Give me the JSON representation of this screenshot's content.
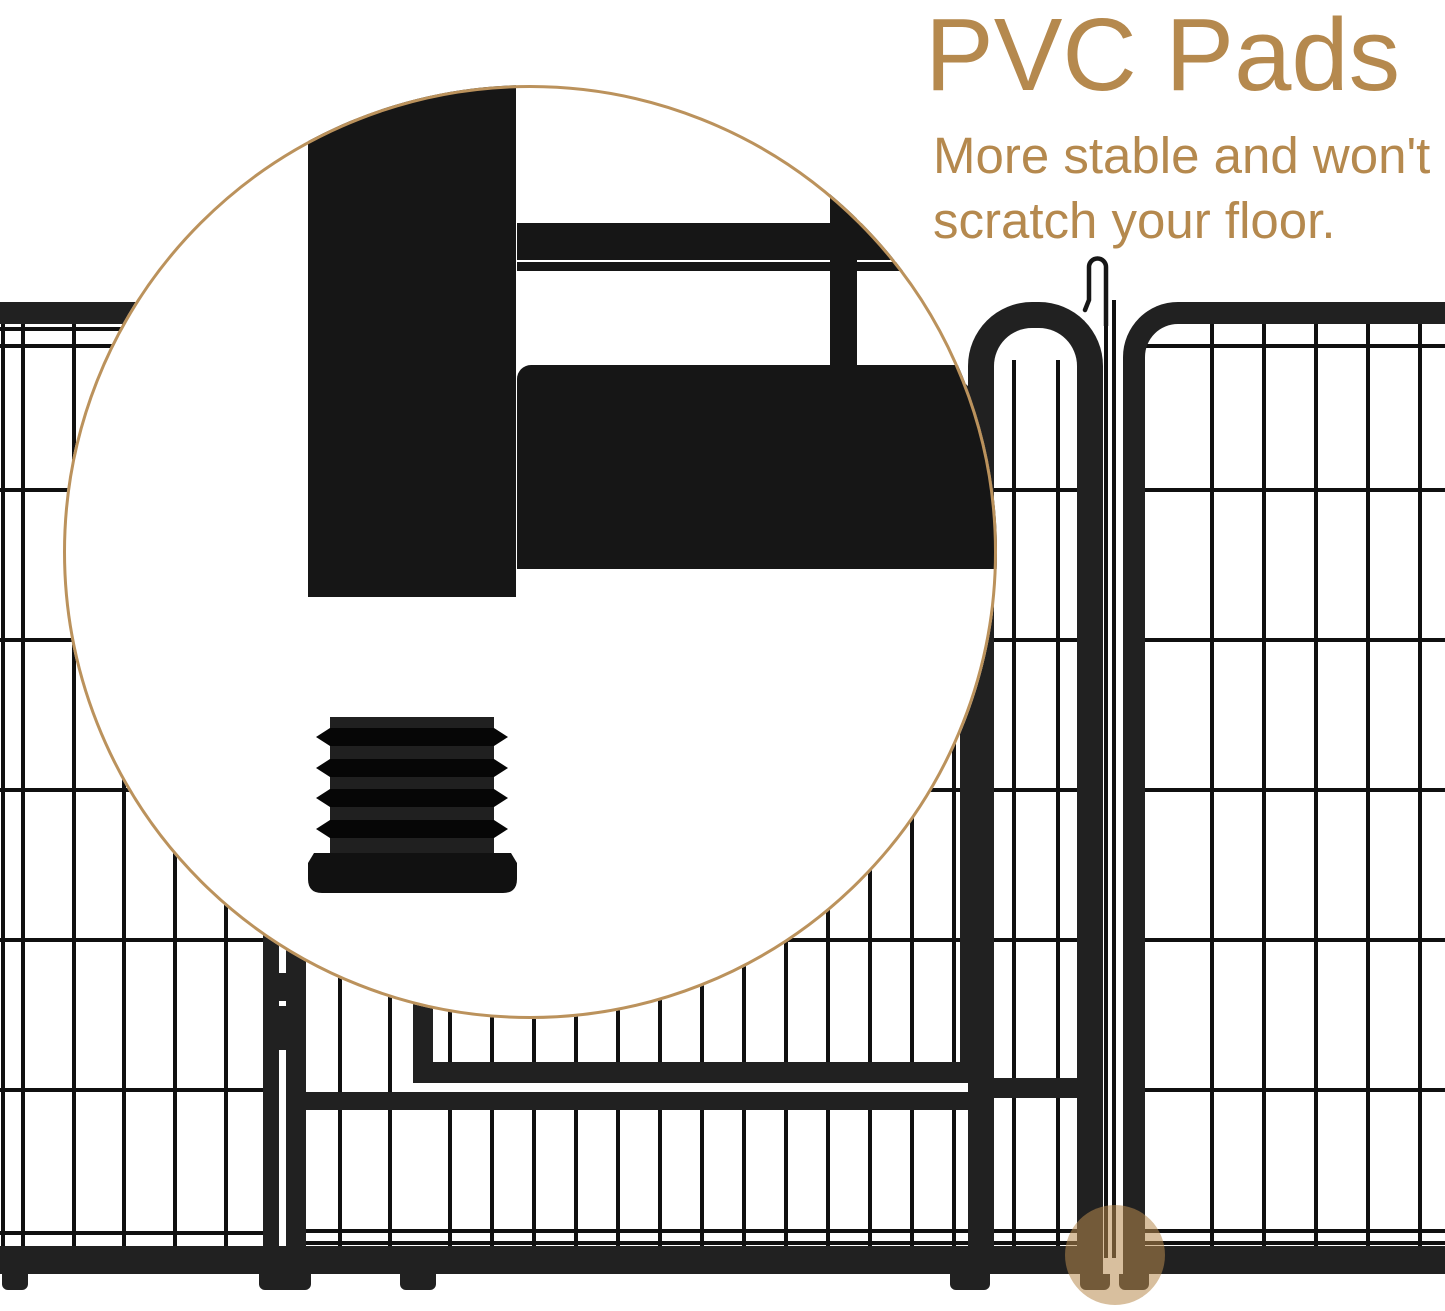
{
  "callout": {
    "title": "PVC Pads",
    "subtitle_line1": "More stable and won't",
    "subtitle_line2": "scratch your floor."
  },
  "icons": {
    "magnifier_circle": "zoom-detail-circle",
    "hook_latch": "candy-cane-hook",
    "pvc_pad": "ribbed-plug-foot",
    "pad_location_highlight": "tan-dot"
  },
  "colors": {
    "accent_tan": "#b5894e",
    "magnifier_ring_tan": "#bb925c",
    "highlight_tan_rgba": "rgba(184,139,78,0.55)",
    "fence_dark": "#212121",
    "wire_dark": "#101010",
    "background": "#ffffff"
  }
}
